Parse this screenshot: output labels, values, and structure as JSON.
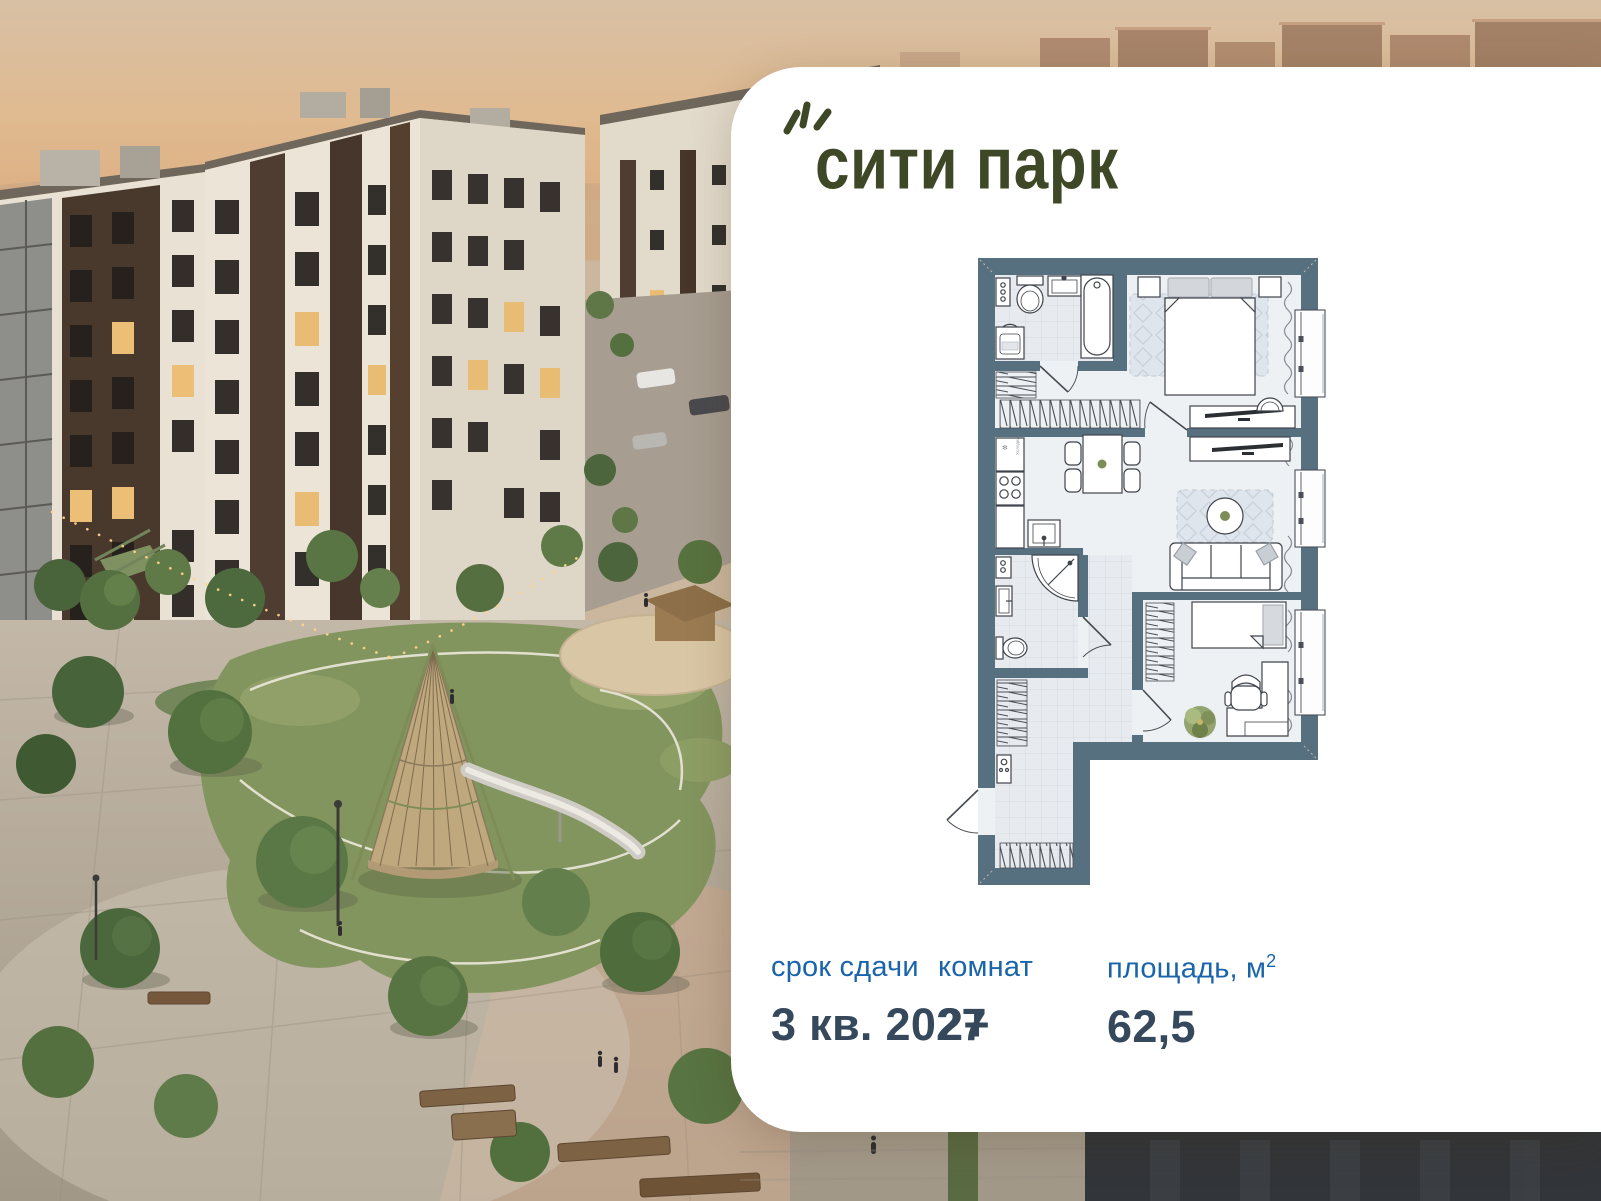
{
  "brand": {
    "name": "сити парк"
  },
  "plan": {
    "fridge_label": "Холодил."
  },
  "stats": {
    "completion": {
      "label": "срок сдачи",
      "value": "3 кв. 2027"
    },
    "rooms": {
      "label": "комнат",
      "value": "2+"
    },
    "area": {
      "label": "площадь, м",
      "sup": "2",
      "value": "62,5"
    }
  },
  "colors": {
    "logo_olive": "#3f4826",
    "stat_label_blue": "#1a64ab",
    "stat_value_navy": "#36495c",
    "plan_wall": "#57707f",
    "card_bg": "#ffffff"
  }
}
